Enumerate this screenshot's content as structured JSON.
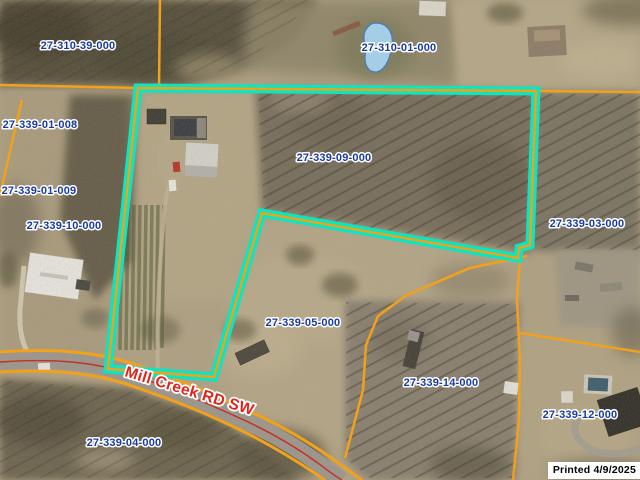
{
  "map": {
    "tool": "county-parcel-map-viewer",
    "highlighted_parcel": "27-339-09-000",
    "parcel_labels": [
      {
        "id": "27-310-39-000",
        "x": 78,
        "y": 49
      },
      {
        "id": "27-310-01-000",
        "x": 399,
        "y": 51
      },
      {
        "id": "27-339-01-008",
        "x": 40,
        "y": 128
      },
      {
        "id": "27-339-01-009",
        "x": 39,
        "y": 194
      },
      {
        "id": "27-339-10-000",
        "x": 64,
        "y": 229
      },
      {
        "id": "27-339-09-000",
        "x": 334,
        "y": 161
      },
      {
        "id": "27-339-03-000",
        "x": 587,
        "y": 227
      },
      {
        "id": "27-339-05-000",
        "x": 303,
        "y": 326
      },
      {
        "id": "27-339-14-000",
        "x": 441,
        "y": 386
      },
      {
        "id": "27-339-12-000",
        "x": 580,
        "y": 418
      },
      {
        "id": "27-339-04-000",
        "x": 124,
        "y": 446
      }
    ],
    "road_label": {
      "text": "Mill Creek RD SW",
      "x": 124,
      "y": 376,
      "angle": 17
    },
    "printed_stamp": "Printed 4/9/2025",
    "colors": {
      "boundary_orange": "#f1a11c",
      "highlight_teal": "#0ce5c2",
      "label_blue": "#1a3a9e",
      "road_red": "#e0241a",
      "centerline_red": "#c62f25",
      "pond_fill": "#a6d5f2",
      "pond_stroke": "#4a7ab8"
    }
  }
}
